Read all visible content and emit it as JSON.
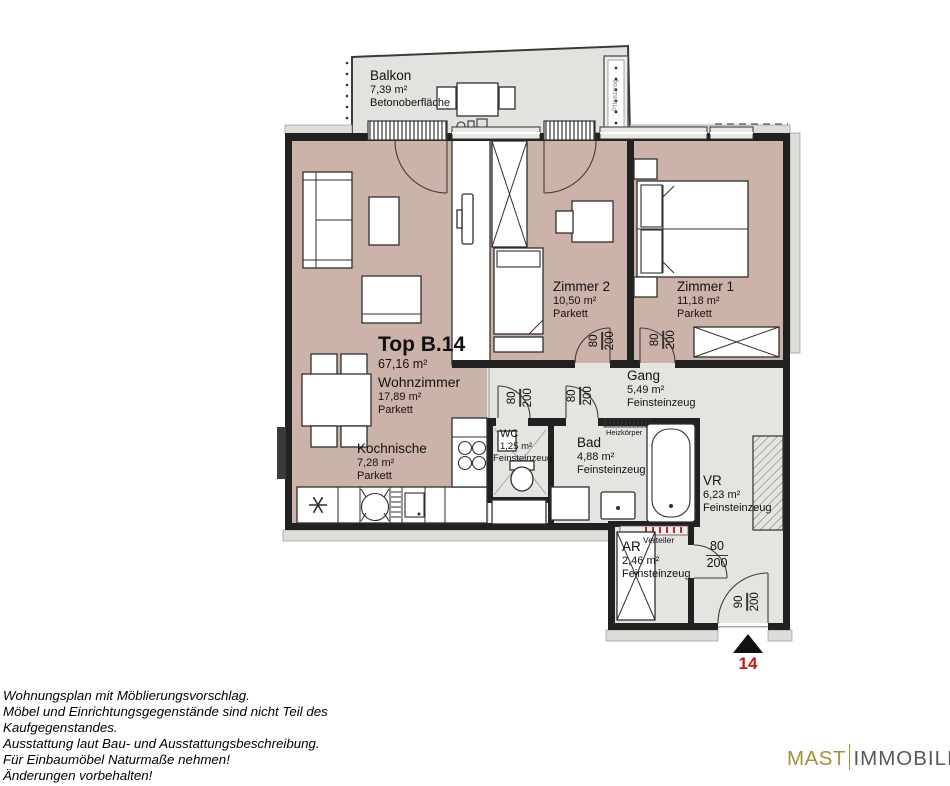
{
  "plan": {
    "unit": {
      "title": "Top B.14",
      "area": "67,16 m²"
    },
    "rooms": {
      "balkon": {
        "name": "Balkon",
        "area": "7,39 m²",
        "floor": "Betonoberfläche"
      },
      "wohnzimmer": {
        "name": "Wohnzimmer",
        "area": "17,89 m²",
        "floor": "Parkett"
      },
      "kochnische": {
        "name": "Kochnische",
        "area": "7,28 m²",
        "floor": "Parkett"
      },
      "zimmer2": {
        "name": "Zimmer 2",
        "area": "10,50 m²",
        "floor": "Parkett"
      },
      "zimmer1": {
        "name": "Zimmer 1",
        "area": "11,18 m²",
        "floor": "Parkett"
      },
      "gang": {
        "name": "Gang",
        "area": "5,49 m²",
        "floor": "Feinsteinzeug"
      },
      "wc": {
        "name": "WC",
        "area": "1,25 m²",
        "floor": "Feinsteinzeug"
      },
      "bad": {
        "name": "Bad",
        "area": "4,88 m²",
        "floor": "Feinsteinzeug"
      },
      "vr": {
        "name": "VR",
        "area": "6,23 m²",
        "floor": "Feinsteinzeug"
      },
      "ar": {
        "name": "AR",
        "area": "2,46 m²",
        "floor": "Feinsteinzeug"
      }
    },
    "equipment": {
      "heizkoerper": "Heizkörper",
      "verteiler": "Verteiler",
      "pflanztrog": "Pflanztrog"
    },
    "door_labels": {
      "w80": "80",
      "w90": "90",
      "h200": "200"
    },
    "entrance_marker": "14"
  },
  "footer": {
    "disclaimer_lines": [
      "Wohnungsplan mit Möblierungsvorschlag.",
      "Möbel und Einrichtungsgegenstände sind nicht Teil des",
      "Kaufgegenstandes.",
      "Ausstattung laut Bau- und Ausstattungsbeschreibung.",
      "Für Einbaumöbel Naturmaße nehmen!",
      "Änderungen vorbehalten!"
    ],
    "logo": {
      "part1": "MAST",
      "part2": "IMMOBILIEN"
    }
  },
  "colors": {
    "parkett": "#ccb3a9",
    "feinsteinzeug": "#e4e4e1",
    "balkon": "#e2e2df",
    "wall": "#212121",
    "accent_red": "#cc1719",
    "logo_gold": "#a29237",
    "logo_gray": "#55575a"
  }
}
